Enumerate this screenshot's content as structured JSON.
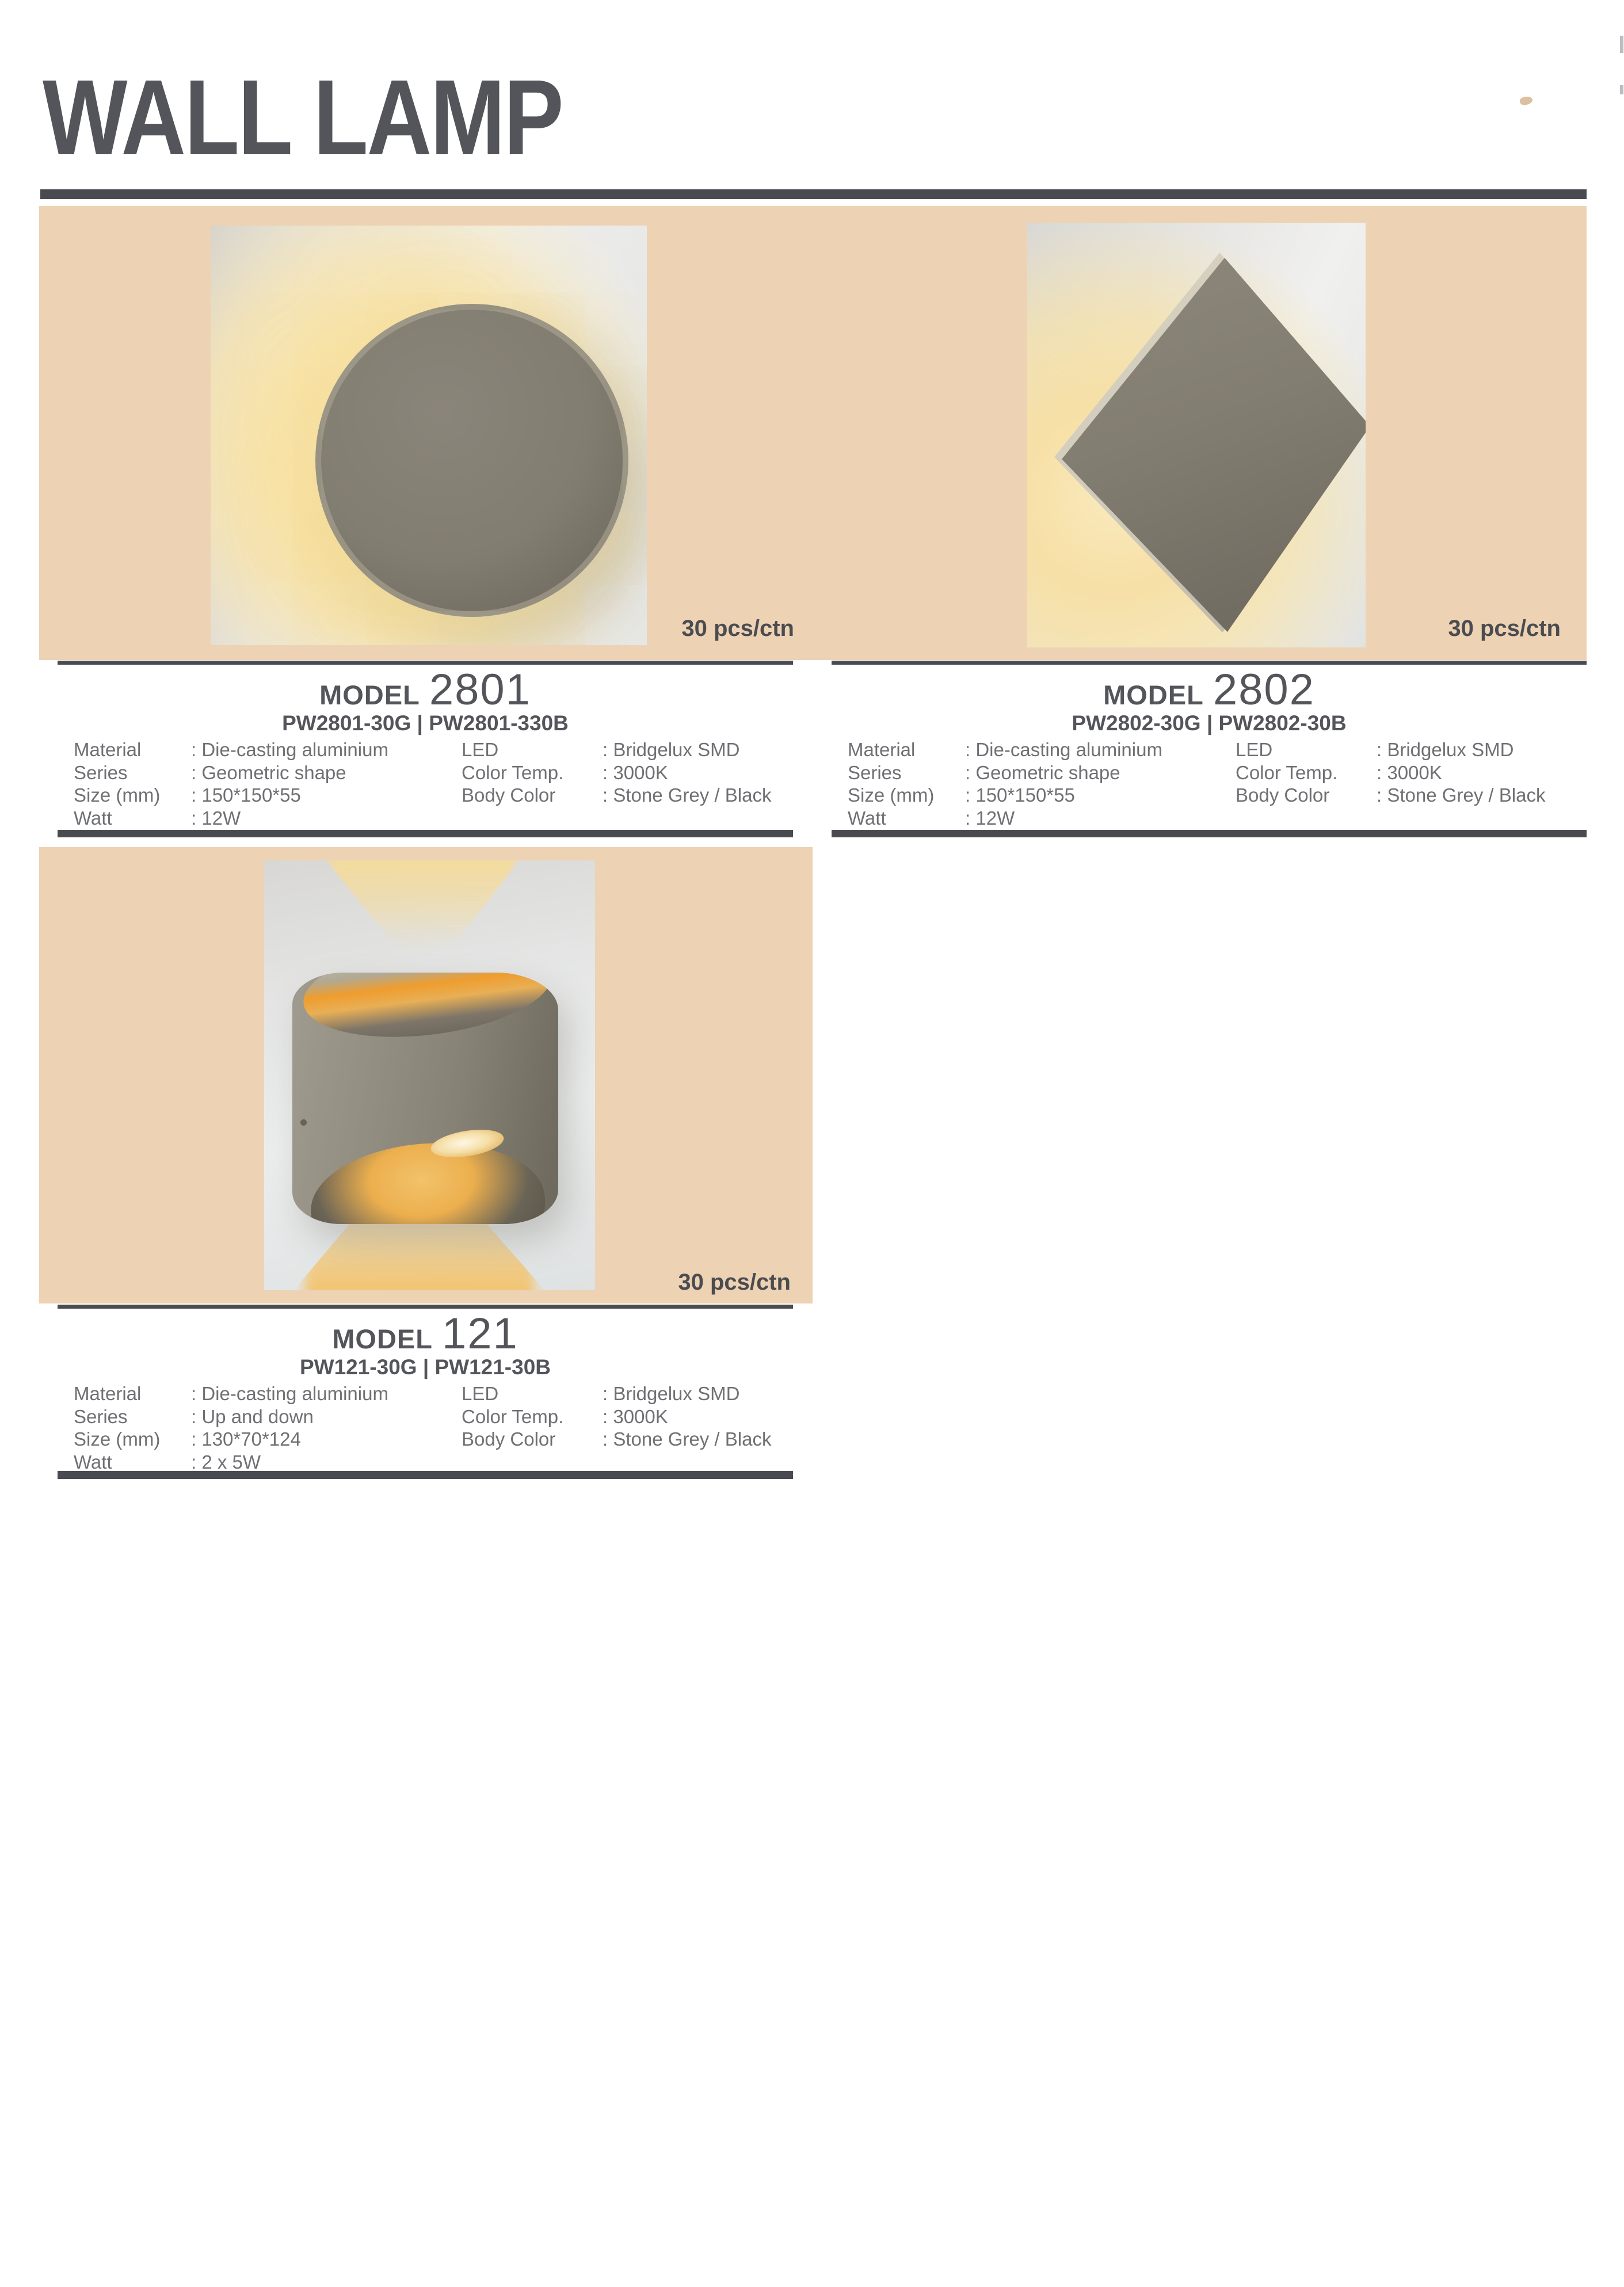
{
  "header": {
    "title": "WALL LAMP"
  },
  "colors": {
    "banner_peach": "#edd2b4",
    "rule_dark": "#4a4b50",
    "title_text": "#54555a",
    "spec_text": "#6f7074",
    "packing_text": "#4b4c50",
    "lamp_grey": "#827d71",
    "glow_warm": "#f7e3ae"
  },
  "icons": {
    "disc_lamp": "round-disc-wall-lamp-photo",
    "diamond_lamp": "diamond-plate-wall-lamp-photo",
    "updown_lamp": "up-down-cylinder-wall-lamp-photo"
  },
  "products": [
    {
      "model_prefix": "MODEL",
      "model_number": "2801",
      "codes": "PW2801-30G | PW2801-330B",
      "packing": "30 pcs/ctn",
      "specs_left": [
        {
          "label": "Material",
          "value": ": Die-casting aluminium"
        },
        {
          "label": "Series",
          "value": ": Geometric shape"
        },
        {
          "label": "Size (mm)",
          "value": ": 150*150*55"
        },
        {
          "label": "Watt",
          "value": ": 12W"
        }
      ],
      "specs_right": [
        {
          "label": "LED",
          "value": ": Bridgelux SMD"
        },
        {
          "label": "Color Temp.",
          "value": ": 3000K"
        },
        {
          "label": "Body Color",
          "value": ": Stone Grey / Black"
        }
      ]
    },
    {
      "model_prefix": "MODEL",
      "model_number": "2802",
      "codes": "PW2802-30G | PW2802-30B",
      "packing": "30 pcs/ctn",
      "specs_left": [
        {
          "label": "Material",
          "value": ": Die-casting aluminium"
        },
        {
          "label": "Series",
          "value": ": Geometric shape"
        },
        {
          "label": "Size (mm)",
          "value": ": 150*150*55"
        },
        {
          "label": "Watt",
          "value": ": 12W"
        }
      ],
      "specs_right": [
        {
          "label": "LED",
          "value": ": Bridgelux SMD"
        },
        {
          "label": "Color Temp.",
          "value": ": 3000K"
        },
        {
          "label": "Body Color",
          "value": ": Stone Grey / Black"
        }
      ]
    },
    {
      "model_prefix": "MODEL",
      "model_number": "121",
      "codes": "PW121-30G | PW121-30B",
      "packing": "30 pcs/ctn",
      "specs_left": [
        {
          "label": "Material",
          "value": ": Die-casting aluminium"
        },
        {
          "label": "Series",
          "value": ": Up and down"
        },
        {
          "label": "Size (mm)",
          "value": ": 130*70*124"
        },
        {
          "label": "Watt",
          "value": ": 2 x 5W"
        }
      ],
      "specs_right": [
        {
          "label": "LED",
          "value": ": Bridgelux SMD"
        },
        {
          "label": "Color Temp.",
          "value": ": 3000K"
        },
        {
          "label": "Body Color",
          "value": ": Stone Grey / Black"
        }
      ]
    }
  ]
}
